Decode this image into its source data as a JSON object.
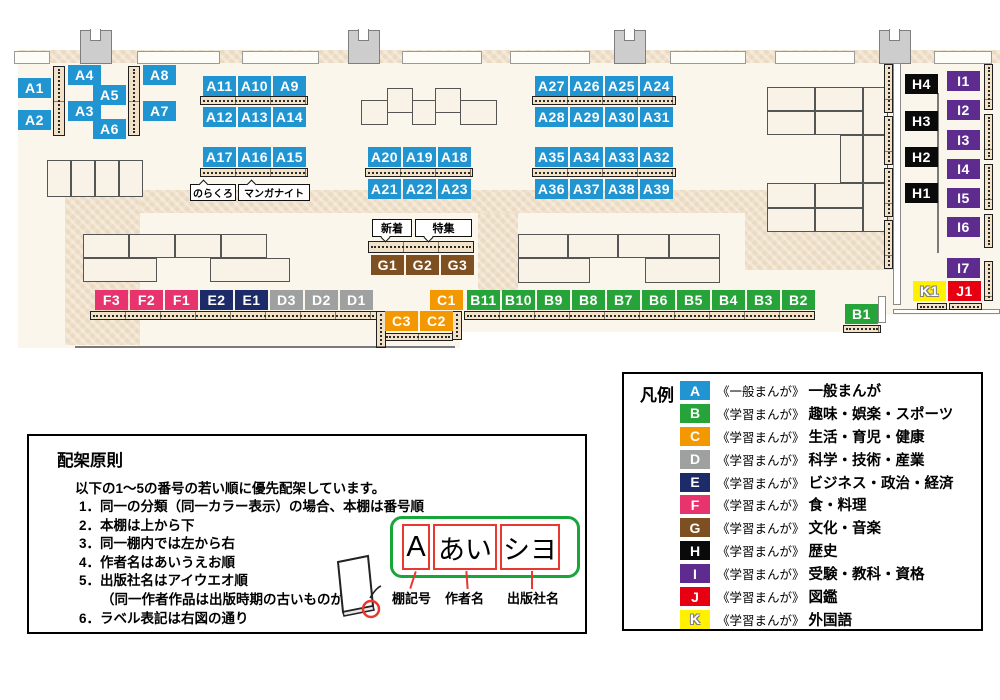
{
  "colors": {
    "A": "#2095D2",
    "B": "#27A439",
    "C": "#F39800",
    "D": "#9FA0A0",
    "E": "#1D2B68",
    "F": "#E7336E",
    "G": "#7D4F21",
    "H": "#0A0A0A",
    "I": "#5E2C8F",
    "J": "#E60012",
    "K": "#FFF100"
  },
  "map": {
    "floor_rects": [
      [
        18,
        50,
        982,
        265
      ],
      [
        18,
        315,
        442,
        33
      ],
      [
        460,
        315,
        420,
        17
      ]
    ],
    "tan_rects": [
      [
        18,
        50,
        982,
        13
      ],
      [
        65,
        190,
        828,
        23
      ],
      [
        65,
        190,
        75,
        155
      ],
      [
        745,
        213,
        148,
        57
      ],
      [
        478,
        213,
        40,
        79
      ]
    ],
    "window_rects": [
      [
        14,
        51,
        36,
        13
      ],
      [
        137,
        51,
        83,
        13
      ],
      [
        242,
        51,
        77,
        13
      ],
      [
        402,
        51,
        80,
        13
      ],
      [
        510,
        51,
        80,
        13
      ],
      [
        670,
        51,
        76,
        13
      ],
      [
        775,
        51,
        80,
        13
      ],
      [
        934,
        51,
        58,
        13
      ]
    ],
    "pillar_rects": [
      [
        80,
        30,
        32,
        34
      ],
      [
        348,
        30,
        32,
        34
      ],
      [
        614,
        30,
        32,
        34
      ],
      [
        879,
        30,
        32,
        34
      ]
    ],
    "wall_rects": [
      [
        893,
        63,
        8,
        242
      ],
      [
        893,
        309,
        107,
        5
      ],
      [
        878,
        296,
        8,
        27
      ]
    ],
    "line_rects": [
      [
        937,
        93,
        2,
        160
      ],
      [
        75,
        346,
        380,
        2
      ]
    ],
    "block_rects": [
      [
        47,
        160,
        24,
        37
      ],
      [
        71,
        160,
        24,
        37
      ],
      [
        95,
        160,
        24,
        37
      ],
      [
        119,
        160,
        24,
        37
      ],
      [
        83,
        234,
        46,
        24
      ],
      [
        129,
        234,
        46,
        24
      ],
      [
        175,
        234,
        46,
        24
      ],
      [
        221,
        234,
        46,
        24
      ],
      [
        83,
        258,
        74,
        24
      ],
      [
        210,
        258,
        80,
        24
      ],
      [
        361,
        100,
        27,
        25
      ],
      [
        387,
        88,
        26,
        25
      ],
      [
        412,
        100,
        24,
        25
      ],
      [
        435,
        88,
        26,
        25
      ],
      [
        460,
        100,
        37,
        25
      ],
      [
        518,
        234,
        50,
        24
      ],
      [
        568,
        234,
        50,
        24
      ],
      [
        618,
        234,
        51,
        24
      ],
      [
        669,
        234,
        51,
        24
      ],
      [
        518,
        258,
        72,
        25
      ],
      [
        645,
        258,
        75,
        25
      ],
      [
        767,
        87,
        48,
        24
      ],
      [
        815,
        87,
        48,
        24
      ],
      [
        767,
        111,
        48,
        24
      ],
      [
        815,
        111,
        48,
        24
      ],
      [
        863,
        87,
        25,
        48
      ],
      [
        863,
        135,
        25,
        48
      ],
      [
        840,
        135,
        23,
        48
      ],
      [
        767,
        183,
        48,
        25
      ],
      [
        815,
        183,
        48,
        25
      ],
      [
        767,
        208,
        48,
        24
      ],
      [
        815,
        208,
        48,
        24
      ],
      [
        863,
        183,
        25,
        49
      ]
    ],
    "strip_h_rects": [
      [
        200,
        96,
        108,
        9
      ],
      [
        200,
        168,
        108,
        9
      ],
      [
        365,
        168,
        108,
        9
      ],
      [
        532,
        96,
        144,
        9
      ],
      [
        532,
        168,
        144,
        9
      ],
      [
        368,
        241,
        106,
        12
      ],
      [
        90,
        311,
        287,
        9
      ],
      [
        383,
        333,
        70,
        8
      ],
      [
        464,
        311,
        351,
        9
      ],
      [
        843,
        325,
        38,
        8
      ],
      [
        917,
        303,
        30,
        7
      ],
      [
        949,
        303,
        33,
        7
      ]
    ],
    "strip_v_rects": [
      [
        53,
        66,
        12,
        70
      ],
      [
        128,
        66,
        12,
        70
      ],
      [
        376,
        311,
        10,
        37
      ],
      [
        452,
        311,
        10,
        29
      ],
      [
        884,
        64,
        9,
        49
      ],
      [
        884,
        116,
        9,
        49
      ],
      [
        884,
        168,
        9,
        49
      ],
      [
        884,
        220,
        9,
        49
      ],
      [
        984,
        64,
        9,
        46
      ],
      [
        984,
        114,
        9,
        46
      ],
      [
        984,
        164,
        9,
        46
      ],
      [
        984,
        214,
        9,
        34
      ],
      [
        984,
        261,
        9,
        40
      ]
    ],
    "labels": [
      {
        "t": "A1",
        "c": "A",
        "x": 18,
        "y": 78
      },
      {
        "t": "A2",
        "c": "A",
        "x": 18,
        "y": 110
      },
      {
        "t": "A4",
        "c": "A",
        "x": 68,
        "y": 65
      },
      {
        "t": "A5",
        "c": "A",
        "x": 93,
        "y": 85
      },
      {
        "t": "A3",
        "c": "A",
        "x": 68,
        "y": 101
      },
      {
        "t": "A6",
        "c": "A",
        "x": 93,
        "y": 119
      },
      {
        "t": "A8",
        "c": "A",
        "x": 143,
        "y": 65
      },
      {
        "t": "A7",
        "c": "A",
        "x": 143,
        "y": 101
      },
      {
        "t": "A11",
        "c": "A",
        "x": 203,
        "y": 76
      },
      {
        "t": "A10",
        "c": "A",
        "x": 238,
        "y": 76
      },
      {
        "t": "A9",
        "c": "A",
        "x": 273,
        "y": 76
      },
      {
        "t": "A12",
        "c": "A",
        "x": 203,
        "y": 107
      },
      {
        "t": "A13",
        "c": "A",
        "x": 238,
        "y": 107
      },
      {
        "t": "A14",
        "c": "A",
        "x": 273,
        "y": 107
      },
      {
        "t": "A17",
        "c": "A",
        "x": 203,
        "y": 147
      },
      {
        "t": "A16",
        "c": "A",
        "x": 238,
        "y": 147
      },
      {
        "t": "A15",
        "c": "A",
        "x": 273,
        "y": 147
      },
      {
        "t": "A27",
        "c": "A",
        "x": 535,
        "y": 76
      },
      {
        "t": "A26",
        "c": "A",
        "x": 570,
        "y": 76
      },
      {
        "t": "A25",
        "c": "A",
        "x": 605,
        "y": 76
      },
      {
        "t": "A24",
        "c": "A",
        "x": 640,
        "y": 76
      },
      {
        "t": "A28",
        "c": "A",
        "x": 535,
        "y": 107
      },
      {
        "t": "A29",
        "c": "A",
        "x": 570,
        "y": 107
      },
      {
        "t": "A30",
        "c": "A",
        "x": 605,
        "y": 107
      },
      {
        "t": "A31",
        "c": "A",
        "x": 640,
        "y": 107
      },
      {
        "t": "A20",
        "c": "A",
        "x": 368,
        "y": 147
      },
      {
        "t": "A19",
        "c": "A",
        "x": 403,
        "y": 147
      },
      {
        "t": "A18",
        "c": "A",
        "x": 438,
        "y": 147
      },
      {
        "t": "A21",
        "c": "A",
        "x": 368,
        "y": 179
      },
      {
        "t": "A22",
        "c": "A",
        "x": 403,
        "y": 179
      },
      {
        "t": "A23",
        "c": "A",
        "x": 438,
        "y": 179
      },
      {
        "t": "A35",
        "c": "A",
        "x": 535,
        "y": 147
      },
      {
        "t": "A34",
        "c": "A",
        "x": 570,
        "y": 147
      },
      {
        "t": "A33",
        "c": "A",
        "x": 605,
        "y": 147
      },
      {
        "t": "A32",
        "c": "A",
        "x": 640,
        "y": 147
      },
      {
        "t": "A36",
        "c": "A",
        "x": 535,
        "y": 179
      },
      {
        "t": "A37",
        "c": "A",
        "x": 570,
        "y": 179
      },
      {
        "t": "A38",
        "c": "A",
        "x": 605,
        "y": 179
      },
      {
        "t": "A39",
        "c": "A",
        "x": 640,
        "y": 179
      },
      {
        "t": "G1",
        "c": "G",
        "x": 371,
        "y": 255
      },
      {
        "t": "G2",
        "c": "G",
        "x": 406,
        "y": 255
      },
      {
        "t": "G3",
        "c": "G",
        "x": 441,
        "y": 255
      },
      {
        "t": "F3",
        "c": "F",
        "x": 95,
        "y": 290
      },
      {
        "t": "F2",
        "c": "F",
        "x": 130,
        "y": 290
      },
      {
        "t": "F1",
        "c": "F",
        "x": 165,
        "y": 290
      },
      {
        "t": "E2",
        "c": "E",
        "x": 200,
        "y": 290
      },
      {
        "t": "E1",
        "c": "E",
        "x": 235,
        "y": 290
      },
      {
        "t": "D3",
        "c": "D",
        "x": 270,
        "y": 290
      },
      {
        "t": "D2",
        "c": "D",
        "x": 305,
        "y": 290
      },
      {
        "t": "D1",
        "c": "D",
        "x": 340,
        "y": 290
      },
      {
        "t": "C1",
        "c": "C",
        "x": 430,
        "y": 290
      },
      {
        "t": "C3",
        "c": "C",
        "x": 385,
        "y": 311
      },
      {
        "t": "C2",
        "c": "C",
        "x": 420,
        "y": 311
      },
      {
        "t": "B11",
        "c": "B",
        "x": 467,
        "y": 290
      },
      {
        "t": "B10",
        "c": "B",
        "x": 502,
        "y": 290
      },
      {
        "t": "B9",
        "c": "B",
        "x": 537,
        "y": 290
      },
      {
        "t": "B8",
        "c": "B",
        "x": 572,
        "y": 290
      },
      {
        "t": "B7",
        "c": "B",
        "x": 607,
        "y": 290
      },
      {
        "t": "B6",
        "c": "B",
        "x": 642,
        "y": 290
      },
      {
        "t": "B5",
        "c": "B",
        "x": 677,
        "y": 290
      },
      {
        "t": "B4",
        "c": "B",
        "x": 712,
        "y": 290
      },
      {
        "t": "B3",
        "c": "B",
        "x": 747,
        "y": 290
      },
      {
        "t": "B2",
        "c": "B",
        "x": 782,
        "y": 290
      },
      {
        "t": "B1",
        "c": "B",
        "x": 845,
        "y": 304
      },
      {
        "t": "H4",
        "c": "H",
        "x": 905,
        "y": 74
      },
      {
        "t": "H3",
        "c": "H",
        "x": 905,
        "y": 111
      },
      {
        "t": "H2",
        "c": "H",
        "x": 905,
        "y": 147
      },
      {
        "t": "H1",
        "c": "H",
        "x": 905,
        "y": 183
      },
      {
        "t": "I1",
        "c": "I",
        "x": 947,
        "y": 71
      },
      {
        "t": "I2",
        "c": "I",
        "x": 947,
        "y": 100
      },
      {
        "t": "I3",
        "c": "I",
        "x": 947,
        "y": 130
      },
      {
        "t": "I4",
        "c": "I",
        "x": 947,
        "y": 159
      },
      {
        "t": "I5",
        "c": "I",
        "x": 947,
        "y": 188
      },
      {
        "t": "I6",
        "c": "I",
        "x": 947,
        "y": 217
      },
      {
        "t": "I7",
        "c": "I",
        "x": 947,
        "y": 258
      },
      {
        "t": "K1",
        "c": "K",
        "x": 913,
        "y": 281
      },
      {
        "t": "J1",
        "c": "J",
        "x": 948,
        "y": 281
      }
    ],
    "annotations": [
      {
        "t": "のらくろ",
        "x": 190,
        "y": 184,
        "w": 46,
        "h": 17,
        "fs": 10,
        "dir": "up"
      },
      {
        "t": "マンガナイト",
        "x": 238,
        "y": 184,
        "w": 72,
        "h": 17,
        "fs": 10,
        "dir": "up"
      },
      {
        "t": "新着",
        "x": 372,
        "y": 219,
        "w": 40,
        "h": 18,
        "fs": 11,
        "dir": "down"
      },
      {
        "t": "特集",
        "x": 415,
        "y": 219,
        "w": 57,
        "h": 18,
        "fs": 11,
        "dir": "down"
      }
    ]
  },
  "legend": {
    "title": "凡例",
    "rows": [
      {
        "key": "A",
        "series": "《一般まんが》",
        "category": "一般まんが"
      },
      {
        "key": "B",
        "series": "《学習まんが》",
        "category": "趣味・娯楽・スポーツ"
      },
      {
        "key": "C",
        "series": "《学習まんが》",
        "category": "生活・育児・健康"
      },
      {
        "key": "D",
        "series": "《学習まんが》",
        "category": "科学・技術・産業"
      },
      {
        "key": "E",
        "series": "《学習まんが》",
        "category": "ビジネス・政治・経済"
      },
      {
        "key": "F",
        "series": "《学習まんが》",
        "category": "食・料理"
      },
      {
        "key": "G",
        "series": "《学習まんが》",
        "category": "文化・音楽"
      },
      {
        "key": "H",
        "series": "《学習まんが》",
        "category": "歴史"
      },
      {
        "key": "I",
        "series": "《学習まんが》",
        "category": "受験・教科・資格"
      },
      {
        "key": "J",
        "series": "《学習まんが》",
        "category": "図鑑"
      },
      {
        "key": "K",
        "series": "《学習まんが》",
        "category": "外国語"
      }
    ]
  },
  "principles": {
    "title": "配架原則",
    "intro": "以下の1～5の番号の若い順に優先配架しています。",
    "items": [
      {
        "text": "1．同一の分類（同一カラー表示）の場合、本棚は番号順",
        "indent": false
      },
      {
        "text": "2．本棚は上から下",
        "indent": false
      },
      {
        "text": "3．同一棚内では左から右",
        "indent": false
      },
      {
        "text": "4．作者名はあいうえお順",
        "indent": false
      },
      {
        "text": "5．出版社名はアイウエオ順",
        "indent": false
      },
      {
        "text": "（同一作者作品は出版時期の古いものが先）",
        "indent": true
      },
      {
        "text": "6．ラベル表記は右図の通り",
        "indent": false
      }
    ]
  },
  "label_diagram": {
    "boxes": [
      "A",
      "あい",
      "シヨ"
    ],
    "captions": [
      "棚記号",
      "作者名",
      "出版社名"
    ]
  }
}
